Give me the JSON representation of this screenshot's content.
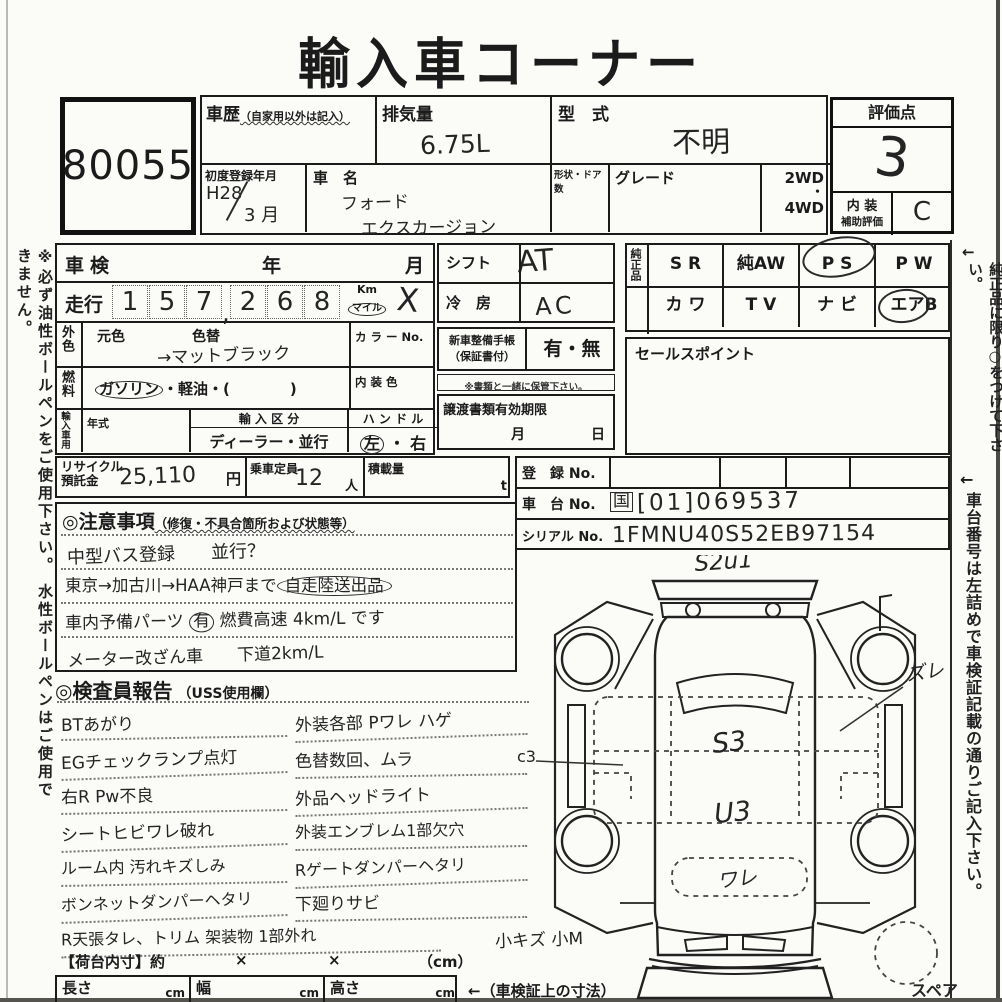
{
  "title": "輸入車コーナー",
  "lot": "80055",
  "header": {
    "history_label": "車歴",
    "history_note": "（自家用以外は記入）",
    "disp_label": "排気量",
    "disp_value": "6.75L",
    "model_label": "型　式",
    "model_value": "不明",
    "firstreg_label": "初度登録年月",
    "firstreg_era": "H28",
    "firstreg_month": "3 月",
    "name_label": "車　名",
    "name_line1": "フォード",
    "name_line2": "エクスカージョン",
    "shape_label": "形状・ドア数",
    "grade_label": "グレード",
    "wd2": "2WD",
    "dot": "・",
    "wd4": "4WD"
  },
  "score": {
    "label": "評価点",
    "value": "3",
    "interior_l1": "内 装",
    "interior_l2": "補助評価",
    "interior_value": "C"
  },
  "lefttab": {
    "shaken": "車検",
    "year": "年",
    "month": "月",
    "mileage": "走行",
    "digits": [
      "1",
      "5",
      "7",
      "2",
      "6",
      "8"
    ],
    "comma": ",",
    "km": "Km",
    "mile": "マイル",
    "cross": "X",
    "gaishoku": "外色",
    "motoiro": "元色",
    "irokae": "色替",
    "iroval": "→マットブラック",
    "colorno": "カ ラ ー No.",
    "fuel": "燃料",
    "fuel_a": "ガソリン",
    "fuel_b": "・軽油・(　　　　)",
    "interior_color": "内 装 色",
    "import": "輸入車用",
    "nenshiki": "年式",
    "kubun": "輸 入 区 分",
    "kubun_val": "ディーラー・並行",
    "handle": "ハ ン ド ル",
    "handle_l": "左",
    "handle_dot": "・",
    "handle_r": "右"
  },
  "midtab": {
    "shift": "シフト",
    "shift_v": "AT",
    "ac": "冷　房",
    "ac_v": "AC",
    "book1": "新車整備手帳",
    "book2": "（保証書付）",
    "book_opts": "有・無",
    "keep": "※書類と一緒に保管下さい。",
    "transfer": "譲渡書類有効期限",
    "t_month": "月",
    "t_day": "日"
  },
  "genuine": {
    "label": "純正品",
    "r1": [
      "S R",
      "純AW",
      "P S",
      "P W"
    ],
    "r2": [
      "カ ワ",
      "T V",
      "ナ ビ",
      "エアB"
    ],
    "sales": "セールスポイント"
  },
  "reg": {
    "reg_label": "登　録 No.",
    "chassis_label": "車　台 No.",
    "chassis_pre": "国",
    "chassis_val": "[01]069537",
    "serial_label": "シリアル No.",
    "serial_val": "1FMNU40S52EB97154"
  },
  "recycle": {
    "l1": "リサイクル",
    "l2": "預託金",
    "val": "25,110",
    "yen": "円",
    "cap": "乗車定員",
    "cap_val": "12",
    "nin": "人",
    "load": "積載量",
    "ton": "t"
  },
  "cautions": {
    "head": "◎注意事項",
    "head_note": "（修復・不具合箇所および状態等）",
    "l1": "中型バス登録　　並行？",
    "l2a": "東京→加古川→HAA神戸まで",
    "l2b": "自走陸送出品",
    "l3a": "車内予備パーツ",
    "l3b": "有",
    "l3c": "燃費高速 4km/L です",
    "l4": "メーター改ざん車　　下道2km/L"
  },
  "inspect": {
    "head": "◎検査員報告",
    "head_note": "（USS使用欄）",
    "left": [
      "BTあがり",
      "EGチェックランプ点灯",
      "右R Pw不良",
      "シートヒビワレ破れ",
      "ルーム内 汚れキズしみ",
      "ボンネットダンパーヘタリ",
      "R天張タレ、トリム 架装物 1部外れ"
    ],
    "right": [
      "外装各部 Pワレ ハゲ",
      "色替数回、ムラ",
      "外品ヘッドライト",
      "外装エンブレム1部欠穴",
      "Rゲートダンパーヘタリ",
      "下廻りサビ",
      "小キズ 小M"
    ],
    "c3": "c3"
  },
  "diagram": {
    "top_mark": "S2u1",
    "s3": "S3",
    "u3": "U3",
    "ware": "ワレ",
    "zure": "ズレ",
    "spare": "スペア"
  },
  "bottom": {
    "dim": "【荷台内寸】約",
    "x1": "×",
    "x2": "×",
    "cm": "（cm）",
    "len": "長さ",
    "len_u": "cm",
    "wid": "幅",
    "wid_u": "cm",
    "hei": "高さ",
    "hei_u": "cm",
    "note": "←（車検証上の寸法）"
  },
  "side": {
    "arrow": "←",
    "left": "※必ず油性ボールペンをご使用下さい。 水性ボールペンはご使用できません。",
    "right1": "純正品に限り○をつけて下さい。",
    "right2": "車台番号は左詰めで車検証記載の通りご記入下さい。"
  }
}
